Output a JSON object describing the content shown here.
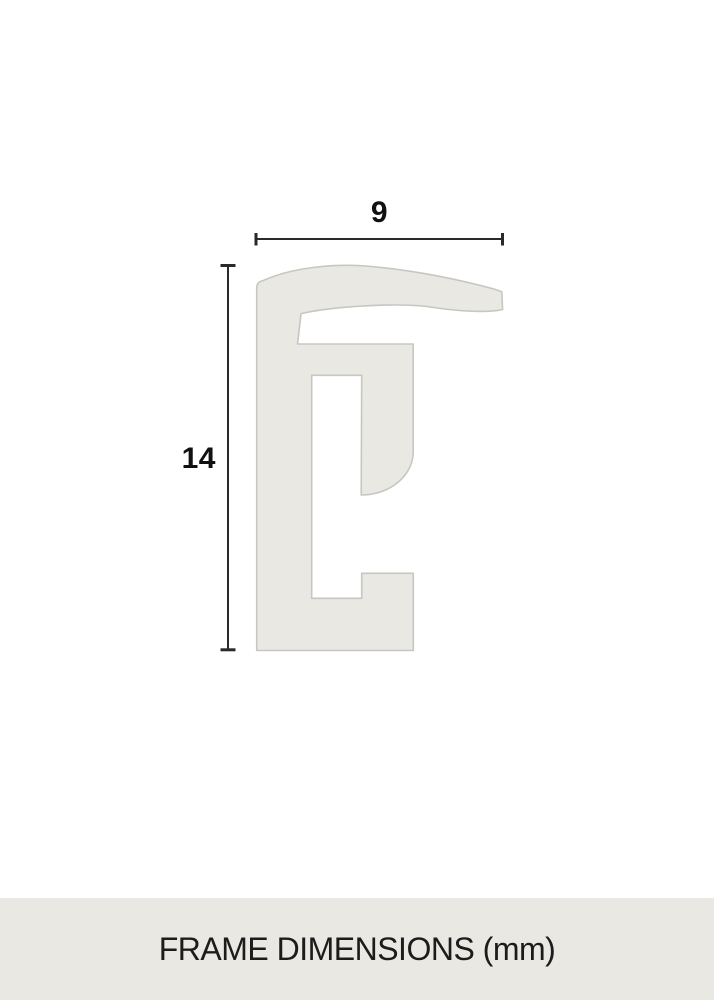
{
  "page": {
    "background": "#ffffff"
  },
  "diagram": {
    "width_dimension": {
      "value": "9"
    },
    "height_dimension": {
      "value": "14"
    },
    "profile_fill": "#e9e8e3",
    "profile_stroke": "#c7c7c2",
    "dimension_color": "#2a2a2a",
    "label_color": "#111111"
  },
  "footer": {
    "label": "FRAME DIMENSIONS (mm)",
    "background": "#e9e8e3",
    "text_color": "#1c1c1c"
  }
}
